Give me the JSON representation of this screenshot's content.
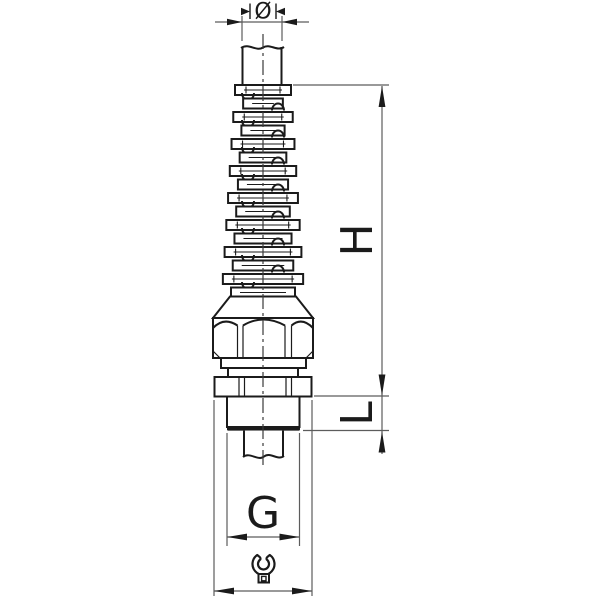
{
  "figure": {
    "type": "technical-drawing-cable-gland-with-spiral-bend-protection",
    "background_color": "#ffffff",
    "outline_color": "#1b1b1b",
    "dimension_line_color": "#5c5c5c"
  },
  "dimensions": {
    "cable_diameter_label": "Ø",
    "overall_height_label": "H",
    "thread_length_label": "L",
    "thread_size_label": "G"
  },
  "icons": {
    "wrench": "open-end-wrench-icon"
  }
}
